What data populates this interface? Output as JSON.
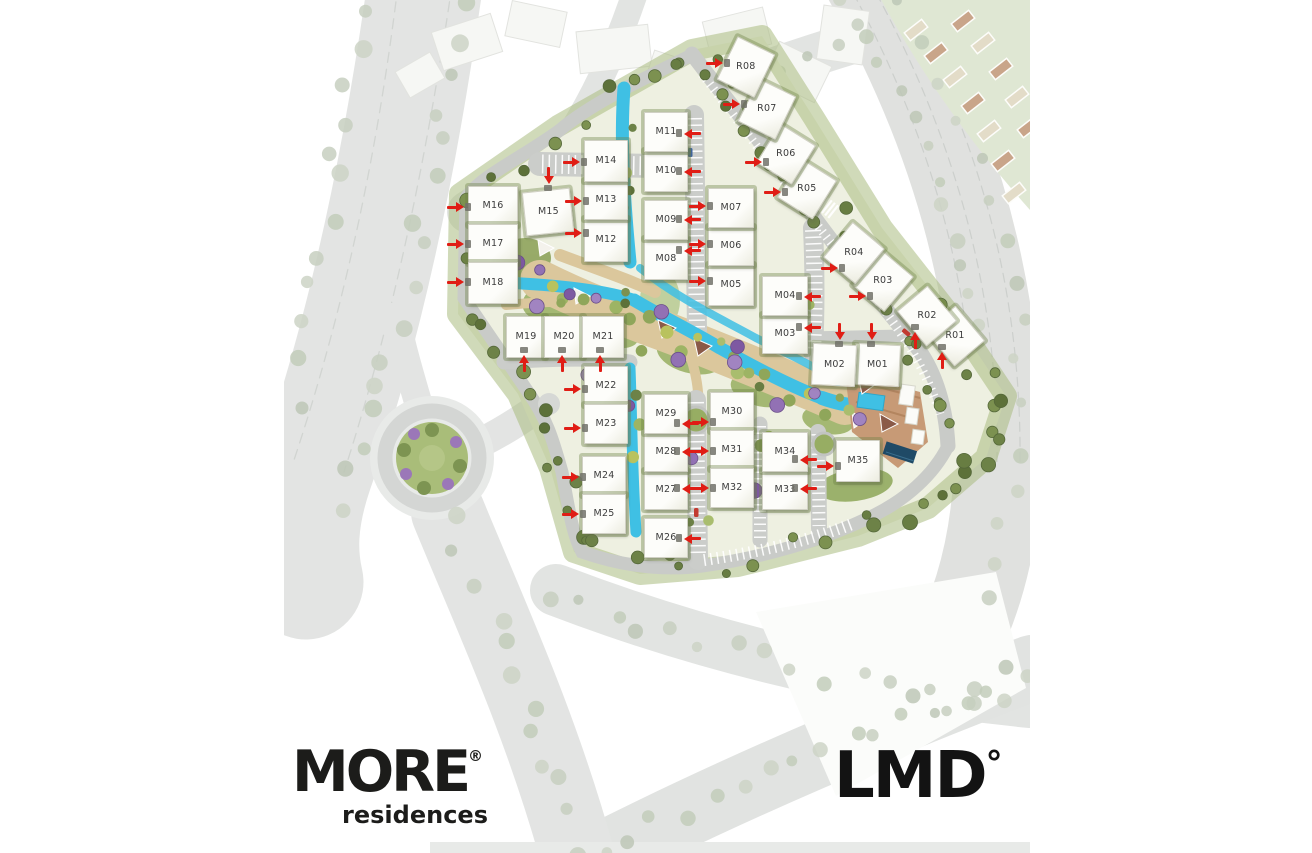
{
  "branding": {
    "project_logo": {
      "name": "MORE",
      "registered": "®",
      "tagline": "residences"
    },
    "developer_logo": {
      "name": "LMD",
      "degree": "°"
    }
  },
  "map": {
    "type": "master-plan",
    "colors": {
      "arrow": "#e01d15",
      "building": "#fdfdfa",
      "label": "#3c3c3c",
      "road": "#cbcdca",
      "water": "#3fc0e4",
      "path_tan": "#dbc79c",
      "lawn": "#9cb268",
      "tree_olive": "#6d8247",
      "tree_purple": "#9271b4"
    },
    "buildings": [
      {
        "label": "M01",
        "x": 854,
        "y": 344,
        "w": 44,
        "h": 40,
        "rot": 3,
        "arrow": {
          "x": 871,
          "y": 331,
          "dir": "down"
        }
      },
      {
        "label": "M02",
        "x": 812,
        "y": 344,
        "w": 42,
        "h": 40,
        "rot": 3,
        "arrow": {
          "x": 839,
          "y": 331,
          "dir": "down"
        }
      },
      {
        "label": "M03",
        "x": 762,
        "y": 314,
        "w": 44,
        "h": 38,
        "rot": 0,
        "arrow": {
          "x": 812,
          "y": 327,
          "dir": "left"
        }
      },
      {
        "label": "M04",
        "x": 762,
        "y": 276,
        "w": 44,
        "h": 38,
        "rot": 0,
        "arrow": {
          "x": 812,
          "y": 296,
          "dir": "left"
        }
      },
      {
        "label": "M05",
        "x": 708,
        "y": 264,
        "w": 44,
        "h": 40,
        "rot": 0,
        "arrow": {
          "x": 697,
          "y": 281,
          "dir": "right"
        }
      },
      {
        "label": "M06",
        "x": 708,
        "y": 226,
        "w": 44,
        "h": 38,
        "rot": 0,
        "arrow": {
          "x": 697,
          "y": 244,
          "dir": "right"
        }
      },
      {
        "label": "M07",
        "x": 708,
        "y": 188,
        "w": 44,
        "h": 38,
        "rot": 0,
        "arrow": {
          "x": 697,
          "y": 206,
          "dir": "right"
        }
      },
      {
        "label": "M08",
        "x": 644,
        "y": 238,
        "w": 42,
        "h": 40,
        "rot": 0,
        "arrow": {
          "x": 692,
          "y": 250,
          "dir": "left"
        }
      },
      {
        "label": "M09",
        "x": 644,
        "y": 200,
        "w": 42,
        "h": 38,
        "rot": 0,
        "arrow": {
          "x": 692,
          "y": 219,
          "dir": "left"
        }
      },
      {
        "label": "M10",
        "x": 644,
        "y": 150,
        "w": 42,
        "h": 40,
        "rot": 0,
        "arrow": {
          "x": 692,
          "y": 171,
          "dir": "left"
        }
      },
      {
        "label": "M11",
        "x": 644,
        "y": 112,
        "w": 42,
        "h": 38,
        "rot": 0,
        "arrow": {
          "x": 692,
          "y": 133,
          "dir": "left"
        }
      },
      {
        "label": "M12",
        "x": 584,
        "y": 218,
        "w": 42,
        "h": 42,
        "rot": 0,
        "arrow": {
          "x": 573,
          "y": 233,
          "dir": "right"
        }
      },
      {
        "label": "M13",
        "x": 584,
        "y": 180,
        "w": 42,
        "h": 38,
        "rot": 0,
        "arrow": {
          "x": 573,
          "y": 201,
          "dir": "right"
        }
      },
      {
        "label": "M14",
        "x": 584,
        "y": 140,
        "w": 42,
        "h": 40,
        "rot": 0,
        "arrow": {
          "x": 571,
          "y": 162,
          "dir": "right"
        }
      },
      {
        "label": "M15",
        "x": 524,
        "y": 190,
        "w": 46,
        "h": 42,
        "rot": -6,
        "arrow": {
          "x": 548,
          "y": 175,
          "dir": "down"
        }
      },
      {
        "label": "M16",
        "x": 468,
        "y": 186,
        "w": 48,
        "h": 38,
        "rot": 0,
        "arrow": {
          "x": 455,
          "y": 207,
          "dir": "right"
        }
      },
      {
        "label": "M17",
        "x": 468,
        "y": 224,
        "w": 48,
        "h": 38,
        "rot": 0,
        "arrow": {
          "x": 455,
          "y": 244,
          "dir": "right"
        }
      },
      {
        "label": "M18",
        "x": 468,
        "y": 262,
        "w": 48,
        "h": 40,
        "rot": 0,
        "arrow": {
          "x": 455,
          "y": 282,
          "dir": "right"
        }
      },
      {
        "label": "M19",
        "x": 506,
        "y": 316,
        "w": 38,
        "h": 40,
        "rot": 0,
        "arrow": {
          "x": 524,
          "y": 363,
          "dir": "up"
        }
      },
      {
        "label": "M20",
        "x": 544,
        "y": 316,
        "w": 38,
        "h": 40,
        "rot": 0,
        "arrow": {
          "x": 562,
          "y": 363,
          "dir": "up"
        }
      },
      {
        "label": "M21",
        "x": 582,
        "y": 316,
        "w": 40,
        "h": 40,
        "rot": 0,
        "arrow": {
          "x": 600,
          "y": 363,
          "dir": "up"
        }
      },
      {
        "label": "M22",
        "x": 584,
        "y": 366,
        "w": 42,
        "h": 38,
        "rot": 0,
        "arrow": {
          "x": 572,
          "y": 389,
          "dir": "right"
        }
      },
      {
        "label": "M23",
        "x": 584,
        "y": 404,
        "w": 42,
        "h": 38,
        "rot": 0,
        "arrow": {
          "x": 572,
          "y": 428,
          "dir": "right"
        }
      },
      {
        "label": "M24",
        "x": 582,
        "y": 456,
        "w": 42,
        "h": 38,
        "rot": 0,
        "arrow": {
          "x": 570,
          "y": 477,
          "dir": "right"
        }
      },
      {
        "label": "M25",
        "x": 582,
        "y": 494,
        "w": 42,
        "h": 38,
        "rot": 0,
        "arrow": {
          "x": 570,
          "y": 514,
          "dir": "right"
        }
      },
      {
        "label": "M26",
        "x": 644,
        "y": 518,
        "w": 42,
        "h": 38,
        "rot": 0,
        "arrow": {
          "x": 692,
          "y": 538,
          "dir": "left"
        }
      },
      {
        "label": "M27",
        "x": 644,
        "y": 470,
        "w": 42,
        "h": 38,
        "rot": 0,
        "arrow": {
          "x": 690,
          "y": 488,
          "dir": "left"
        }
      },
      {
        "label": "M28",
        "x": 644,
        "y": 432,
        "w": 42,
        "h": 38,
        "rot": 0,
        "arrow": {
          "x": 690,
          "y": 451,
          "dir": "left"
        }
      },
      {
        "label": "M29",
        "x": 644,
        "y": 394,
        "w": 42,
        "h": 38,
        "rot": 0,
        "arrow": {
          "x": 690,
          "y": 423,
          "dir": "left"
        }
      },
      {
        "label": "M30",
        "x": 710,
        "y": 392,
        "w": 42,
        "h": 38,
        "rot": 0,
        "arrow": {
          "x": 700,
          "y": 422,
          "dir": "right"
        }
      },
      {
        "label": "M31",
        "x": 710,
        "y": 430,
        "w": 42,
        "h": 38,
        "rot": 0,
        "arrow": {
          "x": 700,
          "y": 451,
          "dir": "right"
        }
      },
      {
        "label": "M32",
        "x": 710,
        "y": 468,
        "w": 42,
        "h": 38,
        "rot": 0,
        "arrow": {
          "x": 700,
          "y": 488,
          "dir": "right"
        }
      },
      {
        "label": "M33",
        "x": 762,
        "y": 470,
        "w": 44,
        "h": 38,
        "rot": 0,
        "arrow": {
          "x": 808,
          "y": 488,
          "dir": "left"
        }
      },
      {
        "label": "M34",
        "x": 762,
        "y": 432,
        "w": 44,
        "h": 38,
        "rot": 0,
        "arrow": {
          "x": 808,
          "y": 459,
          "dir": "left"
        }
      },
      {
        "label": "M35",
        "x": 836,
        "y": 440,
        "w": 42,
        "h": 40,
        "rot": 0,
        "arrow": {
          "x": 825,
          "y": 466,
          "dir": "right"
        }
      },
      {
        "label": "R01",
        "x": 932,
        "y": 316,
        "w": 44,
        "h": 38,
        "rot": 50,
        "arrow": {
          "x": 942,
          "y": 360,
          "dir": "up"
        }
      },
      {
        "label": "R02",
        "x": 904,
        "y": 296,
        "w": 44,
        "h": 38,
        "rot": 50,
        "arrow": {
          "x": 915,
          "y": 340,
          "dir": "up"
        }
      },
      {
        "label": "R03",
        "x": 862,
        "y": 258,
        "w": 40,
        "h": 44,
        "rot": 40,
        "arrow": {
          "x": 857,
          "y": 296,
          "dir": "right"
        }
      },
      {
        "label": "R04",
        "x": 833,
        "y": 230,
        "w": 40,
        "h": 44,
        "rot": 40,
        "arrow": {
          "x": 829,
          "y": 268,
          "dir": "right"
        }
      },
      {
        "label": "R05",
        "x": 786,
        "y": 166,
        "w": 40,
        "h": 44,
        "rot": 32,
        "arrow": {
          "x": 772,
          "y": 192,
          "dir": "right"
        }
      },
      {
        "label": "R06",
        "x": 765,
        "y": 131,
        "w": 40,
        "h": 44,
        "rot": 32,
        "arrow": {
          "x": 753,
          "y": 162,
          "dir": "right"
        }
      },
      {
        "label": "R07",
        "x": 746,
        "y": 85,
        "w": 40,
        "h": 46,
        "rot": 26,
        "arrow": {
          "x": 731,
          "y": 104,
          "dir": "right"
        }
      },
      {
        "label": "R08",
        "x": 725,
        "y": 43,
        "w": 40,
        "h": 46,
        "rot": 26,
        "arrow": {
          "x": 714,
          "y": 63,
          "dir": "right"
        }
      }
    ]
  }
}
